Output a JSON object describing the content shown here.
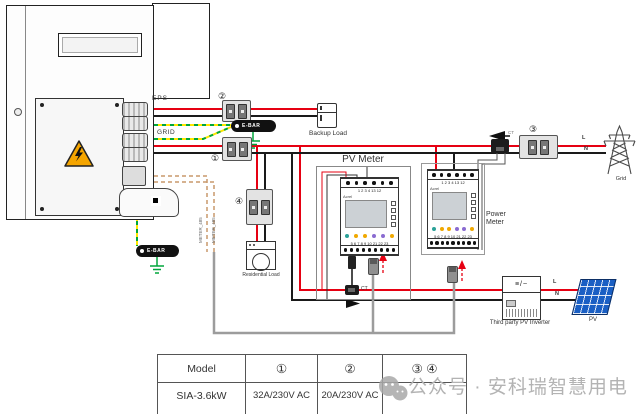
{
  "labels": {
    "eps": "EPS",
    "grid_port": "GRID",
    "ebar_top": "E-BAR",
    "ebar_bottom": "E-BAR",
    "backup_load": "Backup Load",
    "residential_load": "Residential Load",
    "pv_meter": "PV Meter",
    "power_meter": "Power Meter",
    "grid": "Grid",
    "third_party_pv_inverter": "Third party PV Inverter",
    "pv": "PV",
    "line_l_grid": "L",
    "line_n_grid": "N",
    "line_l_pv": "L",
    "line_n_pv": "N",
    "ct_grid": "CT",
    "ct_pv": "CT",
    "breaker1": "①",
    "breaker2": "②",
    "breaker3": "③",
    "breaker4": "④",
    "rs485_a": "METER_485",
    "rs485_b": "METER_485",
    "dc_ac_symbol": "≡/~"
  },
  "meters": {
    "pv": {
      "brand": "Acrel",
      "top_terminals": "1 2 3 4 13 12",
      "bottom_terminals": "5 6 7 8 9 10 21 22 23"
    },
    "power": {
      "brand": "Acrel",
      "top_terminals": "1 2 3 4 13 12",
      "bottom_terminals": "5 6 7 8 9 10 21 22 23"
    }
  },
  "table": {
    "headers": [
      "Model",
      "①",
      "②",
      "③ ④"
    ],
    "row": [
      "SIA-3.6kW",
      "32A/230V AC",
      "20A/230V AC",
      ""
    ]
  },
  "watermark": {
    "text": "公众号 · 安科瑞智慧用电"
  },
  "colors": {
    "wire_red": "#e60012",
    "wire_black": "#1a1a1a",
    "earth_yellow": "#ffe600",
    "earth_green": "#00a63c",
    "comm_tan": "#c8996c",
    "comm_gray": "#9c9c9c",
    "warning_orange": "#f5a500",
    "pv_blue": "#1a5fc4",
    "watermark_gray": "#b3b3b3"
  }
}
